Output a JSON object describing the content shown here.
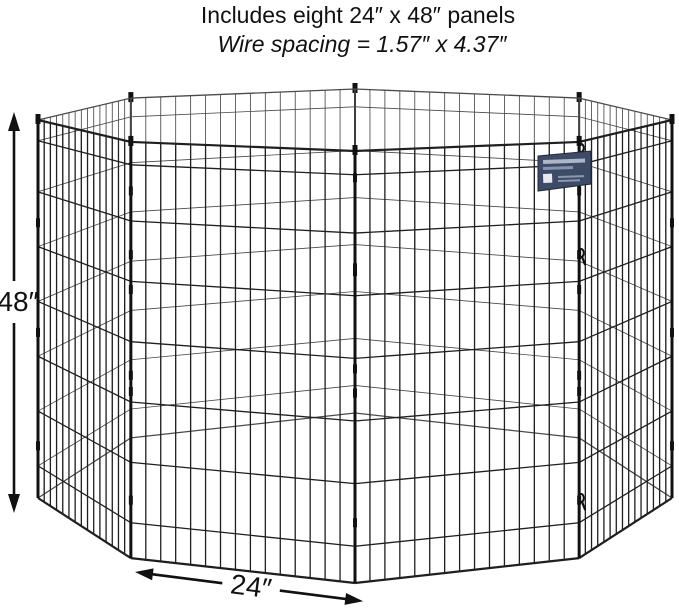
{
  "header": {
    "line1": "Includes eight 24″ x 48″ panels",
    "line2": "Wire spacing = 1.57″ x 4.37″"
  },
  "dimensions": {
    "height_label": "48″",
    "width_label": "24″"
  },
  "pen": {
    "panel_count": 8,
    "panel_width_in": 24,
    "panel_height_in": 48,
    "wire_spacing_in": "1.57 x 4.37",
    "vertical_wires_per_panel": 14,
    "horizontal_fractions": [
      0,
      0.055,
      0.19,
      0.335,
      0.48,
      0.625,
      0.77,
      0.915,
      1
    ],
    "clip_fractions": [
      0.26,
      0.55,
      0.85
    ],
    "snap_hook_y": [
      148,
      253,
      498
    ],
    "colors": {
      "wire_front": "#1f1f1f",
      "wire_back": "#4a4a4a",
      "post": "#111111",
      "annotation": "#111111",
      "label_plate": "#3d4b66",
      "label_plate_text": "#b9c1d4"
    }
  }
}
